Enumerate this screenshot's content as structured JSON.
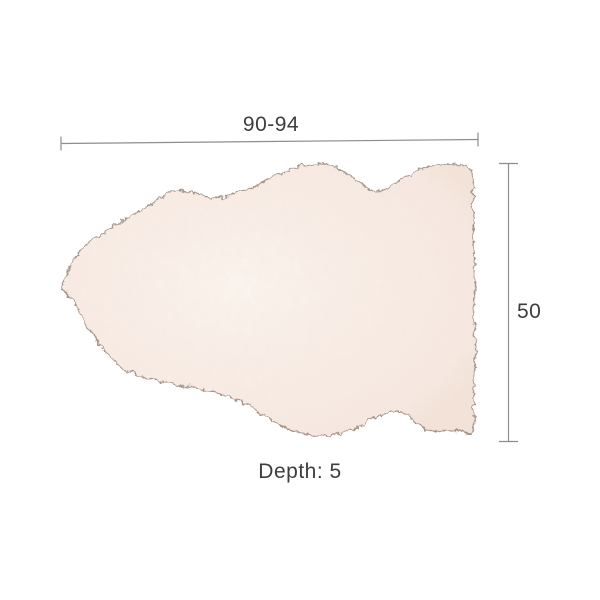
{
  "diagram": {
    "subject": "sheepskin-rug",
    "dimensions": {
      "width_range_label": "90-94",
      "height_label": "50",
      "depth_label": "Depth: 5"
    }
  },
  "colors": {
    "background": "#ffffff",
    "label_text": "#3d3d3d",
    "dimension_line": "#8f8d88",
    "rug_outline": "#97857a",
    "rug_fill": "#f8ece5",
    "rug_fill_light": "#fbf4ee",
    "rug_fill_shade": "#f2e2d7",
    "rug_texture_speck": "#dec2ad"
  }
}
